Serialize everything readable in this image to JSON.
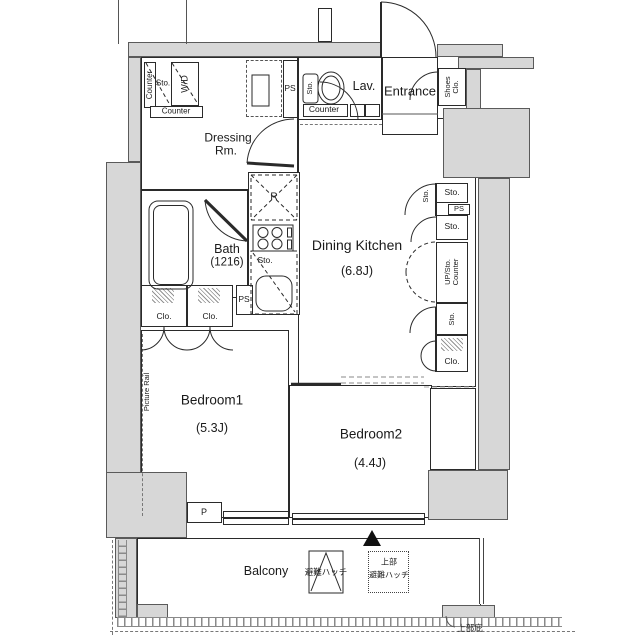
{
  "colors": {
    "wall_fill": "#d7d7d7",
    "wall_edge": "#5a5a5a",
    "line": "#2a2a2a"
  },
  "plan": {
    "dressing": {
      "counter_v": "Counter",
      "sto": "Sto.",
      "wd": "W/D",
      "counter_h": "Counter",
      "name1": "Dressing",
      "name2": "Rm."
    },
    "ps_top": {
      "label": "PS"
    },
    "lav": {
      "name": "Lav.",
      "sto": "Sto.",
      "counter": "Counter"
    },
    "entrance": {
      "name": "Entrance",
      "shoes1": "Shoes",
      "shoes2": "Clo."
    },
    "right_col": {
      "sto_door": "Sto.",
      "sto1": "Sto.",
      "ps": "PS",
      "sto2": "Sto.",
      "upsto1": "UP/Sto.",
      "upsto2": "Counter",
      "sto3": "Sto.",
      "clo": "Clo."
    },
    "dk": {
      "name": "Dining Kitchen",
      "size": "(6.8J)",
      "fridge": "R",
      "sto": "Sto."
    },
    "bath": {
      "name": "Bath",
      "size": "(1216)"
    },
    "ps_mid": {
      "label": "PS"
    },
    "bedroom1": {
      "name": "Bedroom1",
      "size": "(5.3J)",
      "clo1": "Clo.",
      "clo2": "Clo.",
      "rail": "Picture Rail",
      "p": "P"
    },
    "bedroom2": {
      "name": "Bedroom2",
      "size": "(4.4J)"
    },
    "balcony": {
      "name": "Balcony",
      "hatch": "避難ハッチ",
      "upper_hatch1": "上部",
      "upper_hatch2": "避難ハッチ",
      "eave": "上部庇"
    }
  }
}
